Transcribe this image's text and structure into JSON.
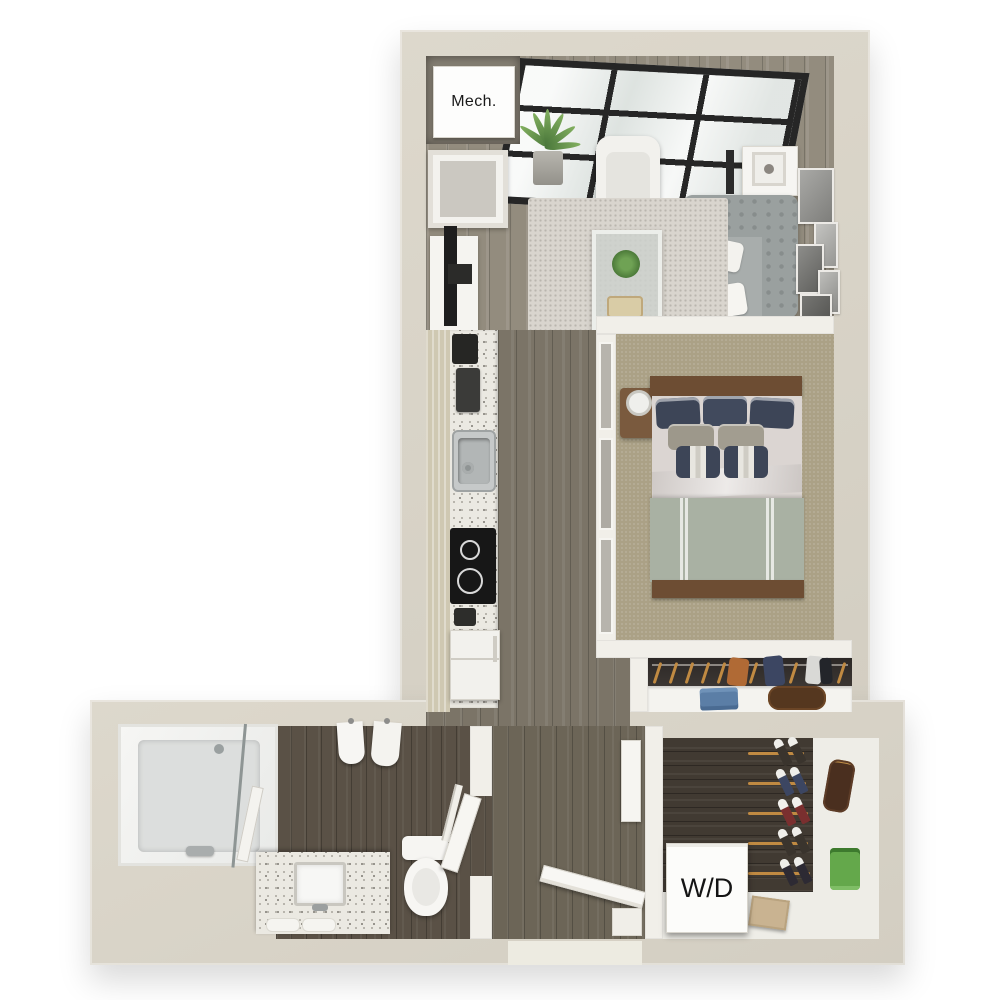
{
  "image": {
    "kind": "3d-floor-plan-render",
    "background": "#ffffff"
  },
  "labels": {
    "mechanical_closet": "Mech.",
    "washer_dryer": "W/D"
  },
  "palette": {
    "exterior_wall": "#d7d2c6",
    "interior_wall": "#f1efe9",
    "living_wood": "#938c7e",
    "corridor_wood": "#7b7467",
    "entry_wood": "#6c6557",
    "bath_wood": "#5a5146",
    "laundry_wood": "#413a32",
    "bedroom_carpet": "#aba186",
    "area_rug": "#d9d5ce",
    "counter_terrazzo": "#ebe9e2",
    "window_frame": "#262626",
    "window_glass": "#edf0ee",
    "sofa_gray": "#9fa4a3",
    "bed_sheet": "#dbd5d2",
    "bed_blanket": "#a9b1a3",
    "pillow_navy": "#3d4557",
    "wood_brown": "#6d4d33",
    "hanger_tan": "#c08a42",
    "shirt_green": "#64a84b",
    "jeans_blue": "#5b7ea6",
    "bag_brown": "#4a2f1f"
  },
  "rooms": [
    {
      "name": "living-room"
    },
    {
      "name": "bedroom"
    },
    {
      "name": "kitchen-corridor"
    },
    {
      "name": "closet"
    },
    {
      "name": "bathroom"
    },
    {
      "name": "entry"
    },
    {
      "name": "laundry-walk-in-closet"
    },
    {
      "name": "mechanical-closet"
    }
  ]
}
